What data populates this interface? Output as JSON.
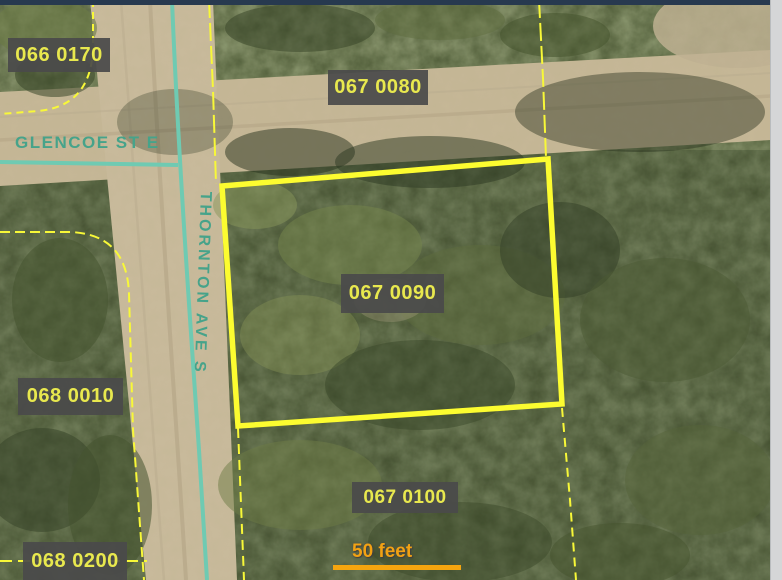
{
  "map": {
    "parcels": [
      {
        "label": "066 0170",
        "highlighted": false
      },
      {
        "label": "067 0080",
        "highlighted": false
      },
      {
        "label": "067 0090",
        "highlighted": true
      },
      {
        "label": "068 0010",
        "highlighted": false
      },
      {
        "label": "067 0100",
        "highlighted": false
      },
      {
        "label": "068 0200",
        "highlighted": false
      }
    ],
    "streets": [
      {
        "name": "GLENCOE ST E",
        "orientation": "horizontal"
      },
      {
        "name": "THORNTON AVE S",
        "orientation": "vertical"
      }
    ],
    "scale_bar": {
      "label": "50 feet"
    },
    "colors": {
      "parcel_line_yellow": "#f8f838",
      "highlight_outline_yellow": "#fcfc30",
      "street_centerline_teal": "#6fcab2",
      "street_text_teal": "#46a38a",
      "parcel_label_bg": "#4a4a4a",
      "parcel_label_text": "#e8e84e",
      "scale_bar_orange": "#f2a213",
      "road_dirt": "#c6b897",
      "top_edge_bar": "#27394f"
    }
  }
}
